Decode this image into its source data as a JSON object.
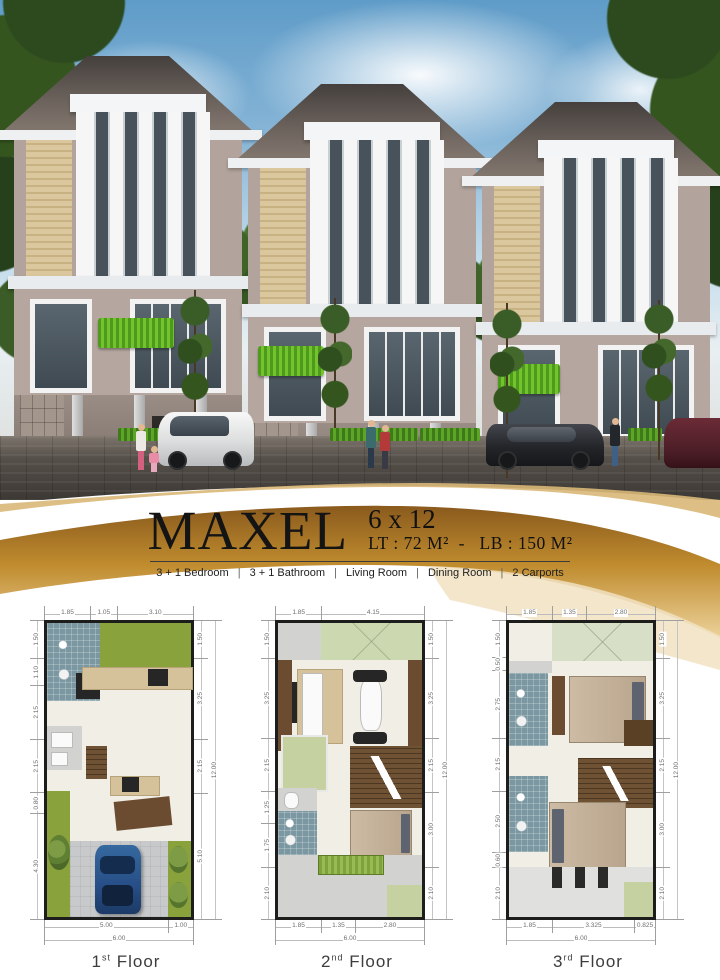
{
  "header": {
    "name": "MAXEL",
    "size": "6 x 12",
    "area": "LT : 72 M²  -   LB : 150 M²"
  },
  "features": {
    "separator": "|",
    "items": [
      "3 + 1 Bedroom",
      "3 + 1 Bathroom",
      "Living Room",
      "Dining Room",
      "2 Carports"
    ]
  },
  "colors": {
    "accent_gold": "#b98a2e",
    "plan_wall": "#1d1d1b",
    "garden_green": "#89a23c",
    "bathroom_tile": "#7b98a2"
  },
  "plans": [
    {
      "label_num": "1",
      "label_sup": "st",
      "label_word": "Floor",
      "dims_top": [
        "1.85",
        "1.05",
        "3.10"
      ],
      "dims_left": [
        "1.50",
        "1.10",
        "2.15",
        "2.15",
        "0.80",
        "4.30"
      ],
      "dims_right": [
        "1.50",
        "3.25",
        "2.15",
        "5.10"
      ],
      "overall_height": "12.00",
      "dims_bottom": [
        "5.00",
        "1.00"
      ],
      "overall_width": "6.00"
    },
    {
      "label_num": "2",
      "label_sup": "nd",
      "label_word": "Floor",
      "dims_top": [
        "1.85",
        "4.15"
      ],
      "dims_left": [
        "1.50",
        "3.25",
        "2.15",
        "1.25",
        "1.75",
        "2.10"
      ],
      "dims_right": [
        "1.50",
        "3.25",
        "2.15",
        "3.00",
        "2.10"
      ],
      "overall_height": "12.00",
      "dims_bottom": [
        "1.85",
        "1.35",
        "2.80"
      ],
      "overall_width": "6.00"
    },
    {
      "label_num": "3",
      "label_sup": "rd",
      "label_word": "Floor",
      "dims_top": [
        "1.85",
        "1.35",
        "2.80"
      ],
      "dims_left": [
        "1.50",
        "0.50",
        "2.75",
        "2.15",
        "2.50",
        "0.60",
        "2.10"
      ],
      "dims_right": [
        "1.50",
        "3.25",
        "2.15",
        "3.00",
        "2.10"
      ],
      "overall_height": "12.00",
      "dims_bottom": [
        "1.85",
        "3.325",
        "0.825"
      ],
      "overall_width": "6.00"
    }
  ]
}
